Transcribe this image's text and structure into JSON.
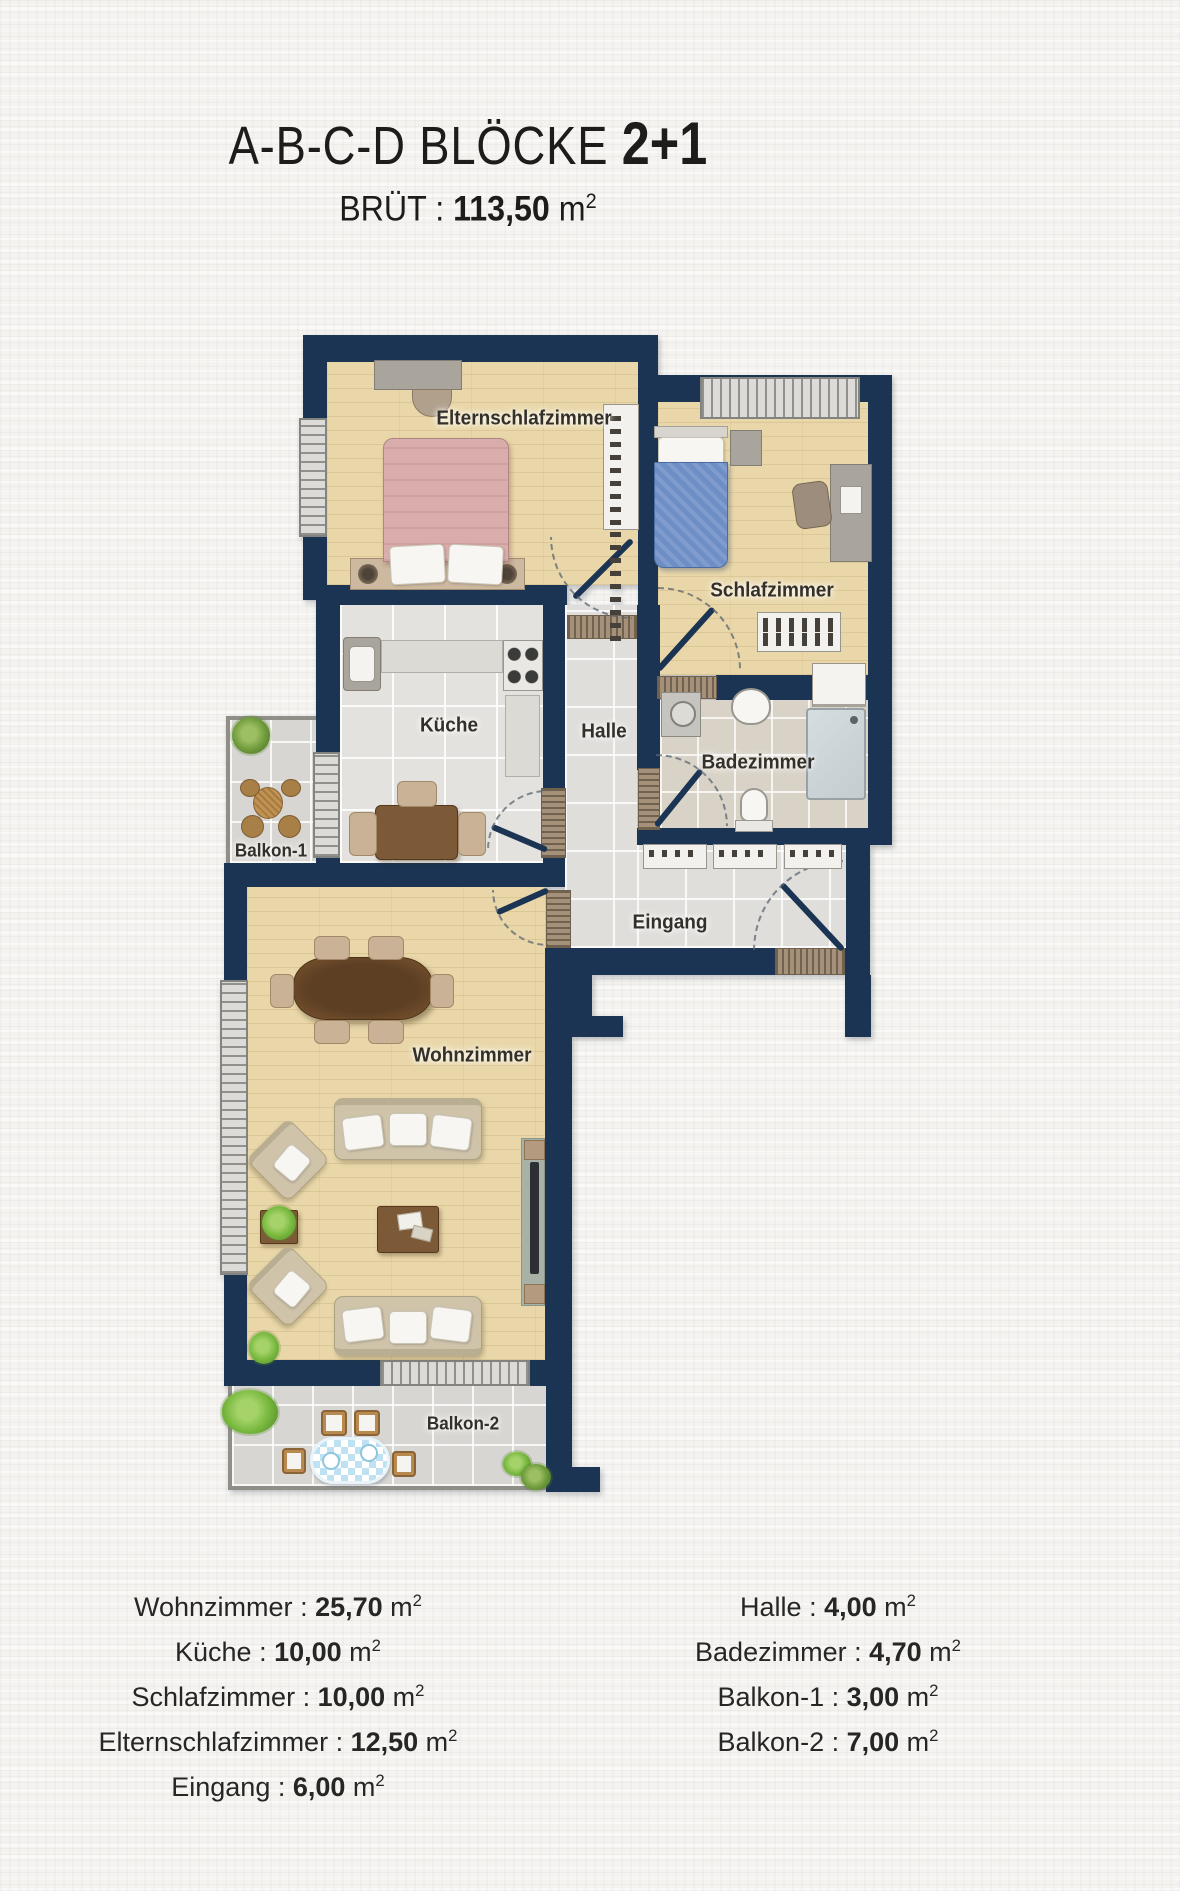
{
  "header": {
    "title": "A-B-C-D BLÖCKE ",
    "title_suffix": "2+1",
    "area_label": "BRÜT : ",
    "area_value": "113,50",
    "unit_base": " m",
    "unit_exp": "2"
  },
  "plan": {
    "rooms": {
      "elternschlafzimmer": "Elternschlafzimmer",
      "schlafzimmer": "Schlafzimmer",
      "kueche": "Küche",
      "halle": "Halle",
      "badezimmer": "Badezimmer",
      "eingang": "Eingang",
      "wohnzimmer": "Wohnzimmer",
      "balkon1": "Balkon-1",
      "balkon2": "Balkon-2"
    }
  },
  "legend": {
    "sep": " : ",
    "unit_base": " m",
    "unit_exp": "2",
    "left": [
      {
        "label": "Wohnzimmer",
        "value": "25,70"
      },
      {
        "label": "Küche",
        "value": "10,00"
      },
      {
        "label": "Schlafzimmer",
        "value": "10,00"
      },
      {
        "label": "Elternschlafzimmer",
        "value": "12,50"
      },
      {
        "label": "Eingang",
        "value": "6,00"
      }
    ],
    "right": [
      {
        "label": "Halle",
        "value": "4,00"
      },
      {
        "label": "Badezimmer",
        "value": "4,70"
      },
      {
        "label": "Balkon-1",
        "value": "3,00"
      },
      {
        "label": "Balkon-2",
        "value": "7,00"
      }
    ]
  },
  "colors": {
    "paper": "#f4f3f0",
    "ink": "#1d1c1a",
    "label": "#33302a",
    "wall": "#1b3453",
    "wood": "#e9d7a9",
    "tile": "#e3e2de",
    "halletile": "#dfdedb",
    "bathtile": "#d9d3c7",
    "baltile": "#d7d6d2",
    "counter": "#dcdad5",
    "bedpink": "#d8adab",
    "bedblue": "#6e8fc6",
    "beige": "#cfc3aa",
    "brown": "#7d5a37",
    "green": "#79b93f",
    "olive": "#6f9c3d"
  }
}
